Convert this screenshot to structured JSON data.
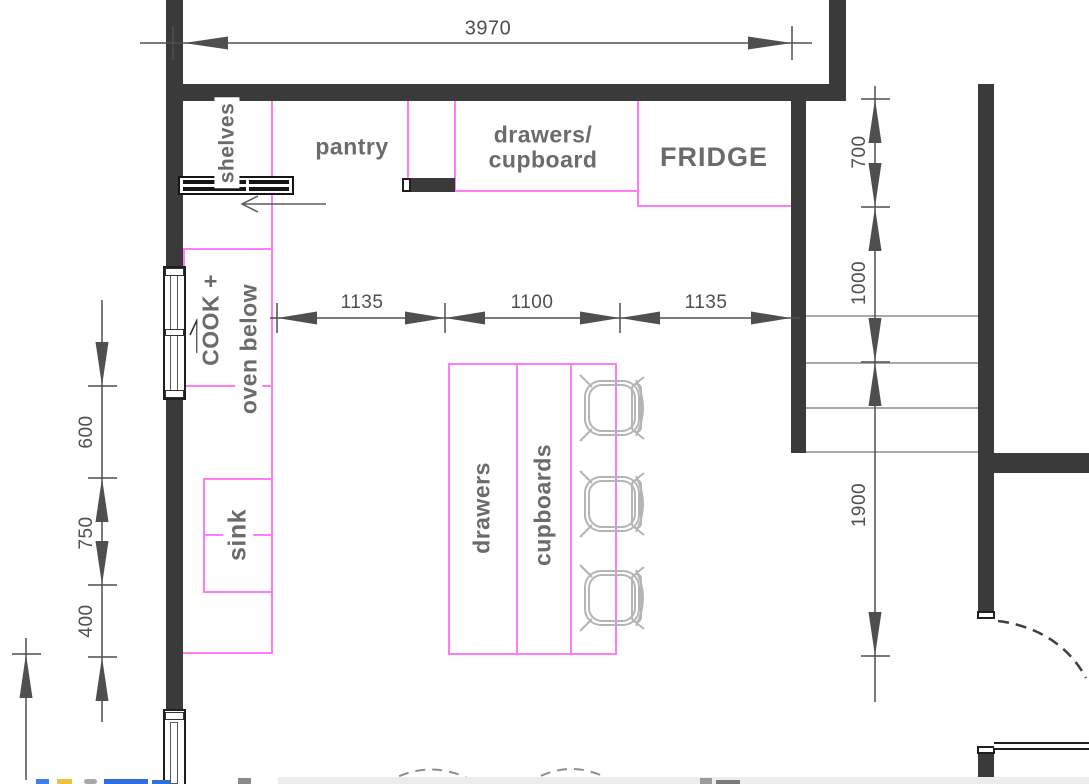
{
  "drawing": {
    "type": "kitchen-floor-plan",
    "units": "mm"
  },
  "labels": {
    "shelves": "shelves",
    "pantry": "pantry",
    "upper_cabinet_line1": "drawers/",
    "upper_cabinet_line2": "cupboard",
    "fridge": "FRIDGE",
    "cook_line1": "COOK +",
    "cook_line2": "oven below",
    "sink": "sink",
    "island_drawers": "drawers",
    "island_cupboards": "cupboards"
  },
  "dimensions": {
    "top": "3970",
    "mid": [
      "1135",
      "1100",
      "1135"
    ],
    "left": [
      "600",
      "750",
      "400"
    ],
    "right": [
      "700",
      "1000",
      "1900"
    ]
  },
  "colors": {
    "wall": "#3a3a3a",
    "cabinet_outline": "#ff7cf8",
    "dimension": "#4f4f4f",
    "label_text": "#6b6b6b",
    "stool_outline": "#b5b5b5",
    "stair_tread": "#a9a9a9"
  },
  "counts": {
    "bar_stools": 3,
    "stair_treads": 4
  }
}
